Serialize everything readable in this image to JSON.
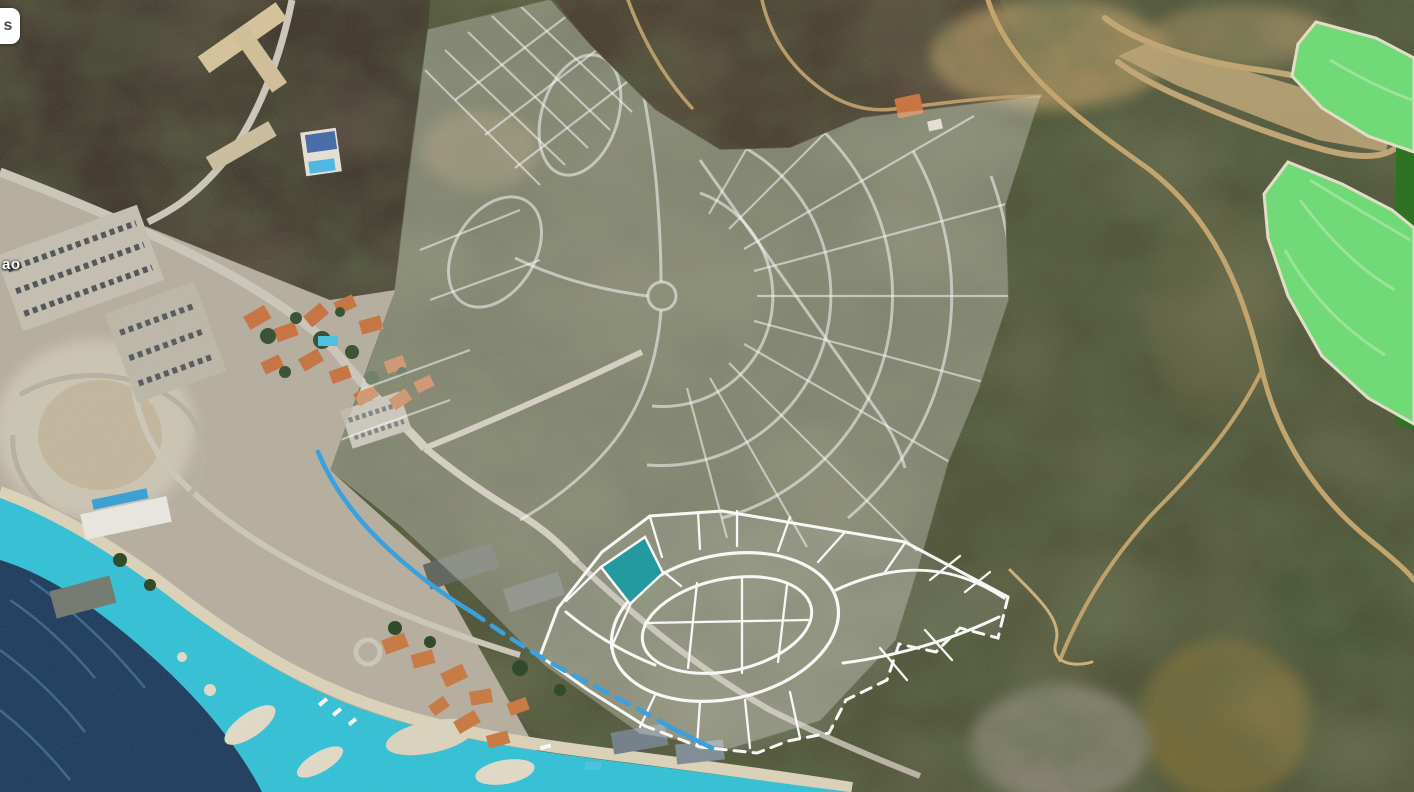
{
  "map": {
    "view_type": "satellite",
    "place_label": "ao",
    "control_button_label": "s",
    "colors": {
      "selected_plot": "#13989e",
      "phase_outline": "#ffffff",
      "masterplan_line": "#ffffff",
      "boundary_line": "#2d9fe4",
      "lake_green": "#69de72",
      "lake_dark_green": "#1f6b15",
      "lagoon": "#2cc2da",
      "ocean": "#16365a"
    }
  }
}
